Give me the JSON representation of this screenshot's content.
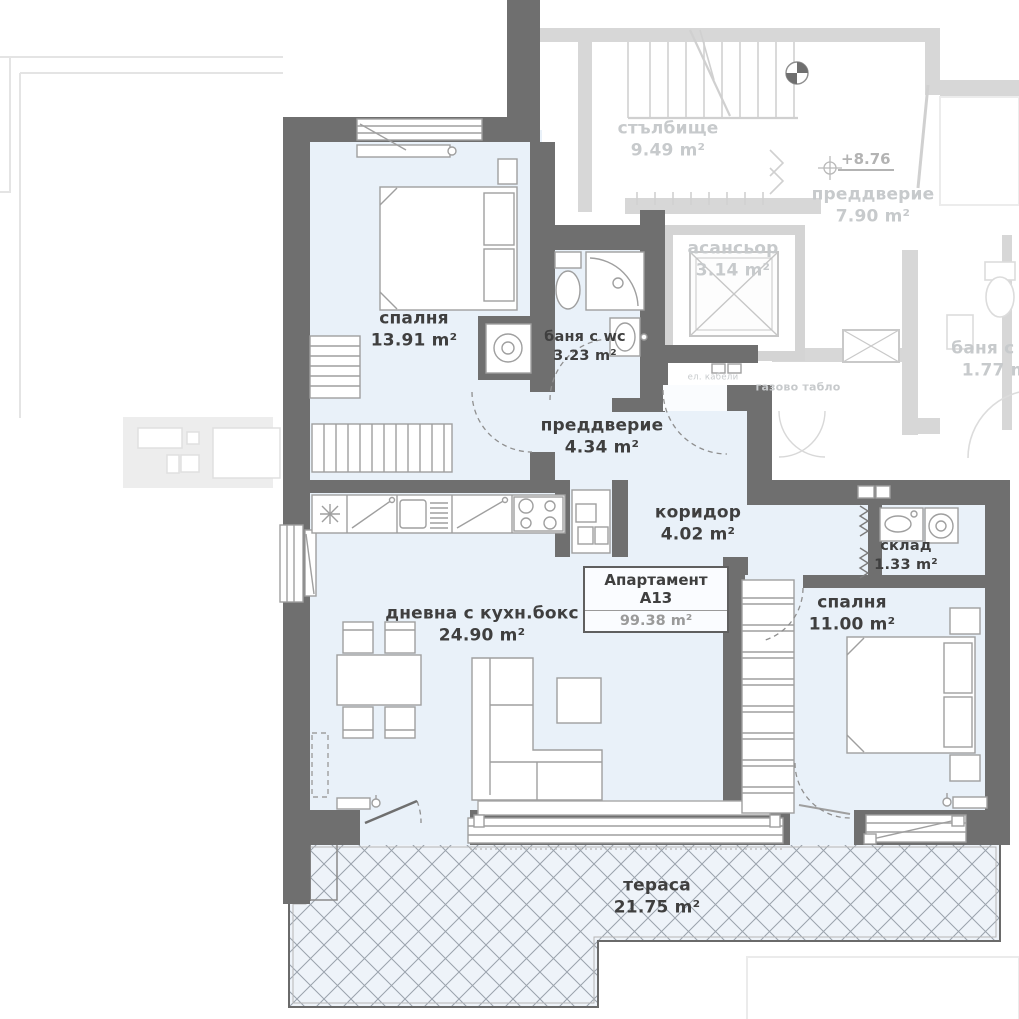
{
  "plan": {
    "apartment": {
      "info_box": {
        "title": "Апартамент А13",
        "area": "99.38 m²"
      },
      "rooms": {
        "bedroom1": {
          "name": "спалня",
          "area": "13.91 m²"
        },
        "bathroom": {
          "name": "баня с wc",
          "area": "3.23 m²"
        },
        "entry_hall": {
          "name": "преддверие",
          "area": "4.34 m²"
        },
        "corridor": {
          "name": "коридор",
          "area": "4.02 m²"
        },
        "storage": {
          "name": "склад",
          "area": "1.33 m²"
        },
        "bedroom2": {
          "name": "спалня",
          "area": "11.00 m²"
        },
        "living": {
          "name": "дневна с кухн.бокс",
          "area": "24.90 m²"
        },
        "terrace": {
          "name": "тераса",
          "area": "21.75 m²"
        }
      }
    },
    "common_areas": {
      "staircase": {
        "name": "стълбище",
        "area": "9.49 m²"
      },
      "hallway": {
        "name": "преддверие",
        "area": "7.90 m²"
      },
      "elevator": {
        "name": "асансьор",
        "area": "3.14 m²"
      },
      "neighbor_bathroom": {
        "name": "баня с wc",
        "area": "1.77 m²"
      },
      "level_mark": "+8.76",
      "gas_panel_label": "газово табло",
      "electric_cables_label": "ел. кабели"
    },
    "colors": {
      "walls": "#6f6f6f",
      "room_fill": "#e9f1f9",
      "common_lines": "#d0d0d0",
      "label_dark": "#3f3f3f",
      "label_light": "#c7cacc",
      "hatch_line": "#9aa2ac"
    }
  }
}
